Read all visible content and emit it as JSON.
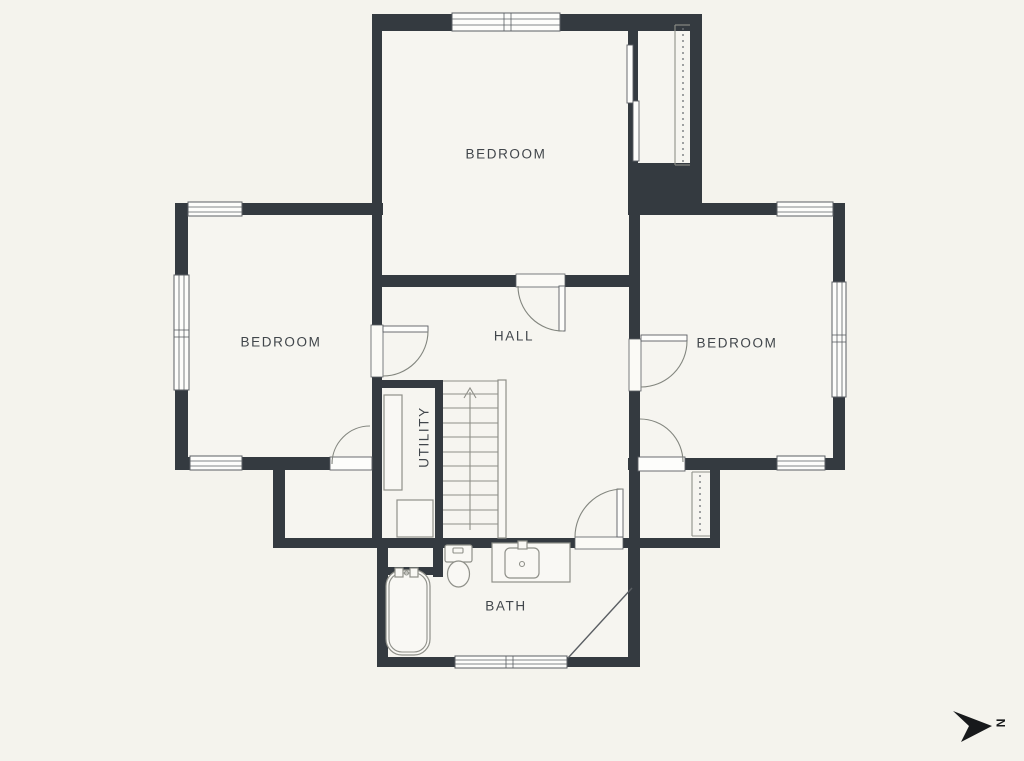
{
  "rooms": {
    "bedroom_top": {
      "label": "BEDROOM"
    },
    "bedroom_left": {
      "label": "BEDROOM"
    },
    "bedroom_right": {
      "label": "BEDROOM"
    },
    "hall": {
      "label": "HALL"
    },
    "utility": {
      "label": "UTILITY"
    },
    "bath": {
      "label": "BATH"
    }
  },
  "compass": {
    "north_label": "N"
  },
  "colors": {
    "background": "#f4f3ed",
    "room_fill": "#f6f5f0",
    "wall": "#343a40",
    "text": "#41464b",
    "fixture_line": "#8f9089",
    "compass": "#17191b"
  }
}
